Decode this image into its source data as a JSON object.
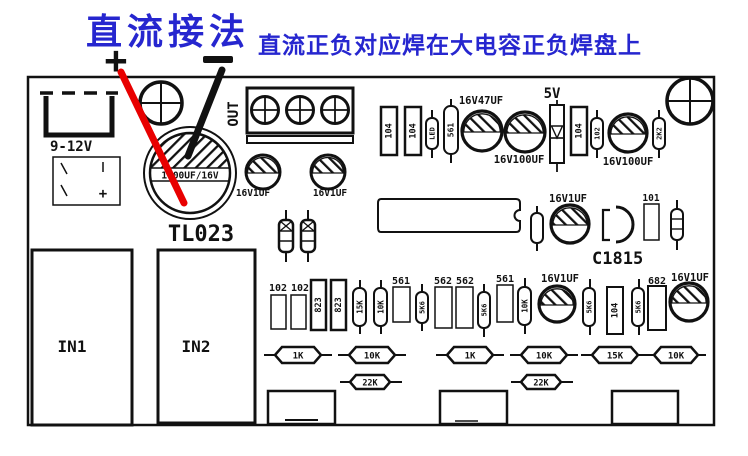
{
  "annotation": {
    "title": "直流接法",
    "subtitle": "直流正负对应焊在大电容正负焊盘上",
    "plus": "+"
  },
  "colors": {
    "blue": "#2626cf",
    "red": "#e80000",
    "ink": "#111111"
  },
  "board": {
    "dc_jack": "9-12V",
    "polarity_plus": "+",
    "big_cap": "1000UF/16V",
    "name": "TL023",
    "out": "OUT",
    "transistor": "C1815"
  },
  "top": {
    "c104a": "104",
    "c104b": "104",
    "led": "LED",
    "r561": "561",
    "cap47": "16V47UF",
    "cap100a": "16V100UF",
    "zener5v": "5V",
    "c104c": "104",
    "d102": "102",
    "cap100b": "16V100UF",
    "r2k2": "2K2"
  },
  "mid": {
    "cap1a": "16V1UF",
    "cap1b": "16V1UF",
    "cap1c": "16V1UF",
    "r101": "101"
  },
  "bottom": {
    "in1": "IN1",
    "in2": "IN2",
    "c102a": "102",
    "c102b": "102",
    "r823a": "823",
    "r823b": "823",
    "r15k": "15K",
    "r10ka": "10K",
    "r561a": "561",
    "r5k6a": "5K6",
    "r562a": "562",
    "r562b": "562",
    "r5k6b": "5K6",
    "r561b": "561",
    "r10kb": "10K",
    "cap1d": "16V1UF",
    "r5k6c": "5K6",
    "c104v": "104",
    "r5k6d": "5K6",
    "r682": "682",
    "cap1e": "16V1UF"
  },
  "axial": {
    "r1": "1K",
    "r2": "10K",
    "r3": "1K",
    "r4": "10K",
    "r5": "15K",
    "r6": "10K",
    "r22a": "22K",
    "r22b": "22K"
  }
}
